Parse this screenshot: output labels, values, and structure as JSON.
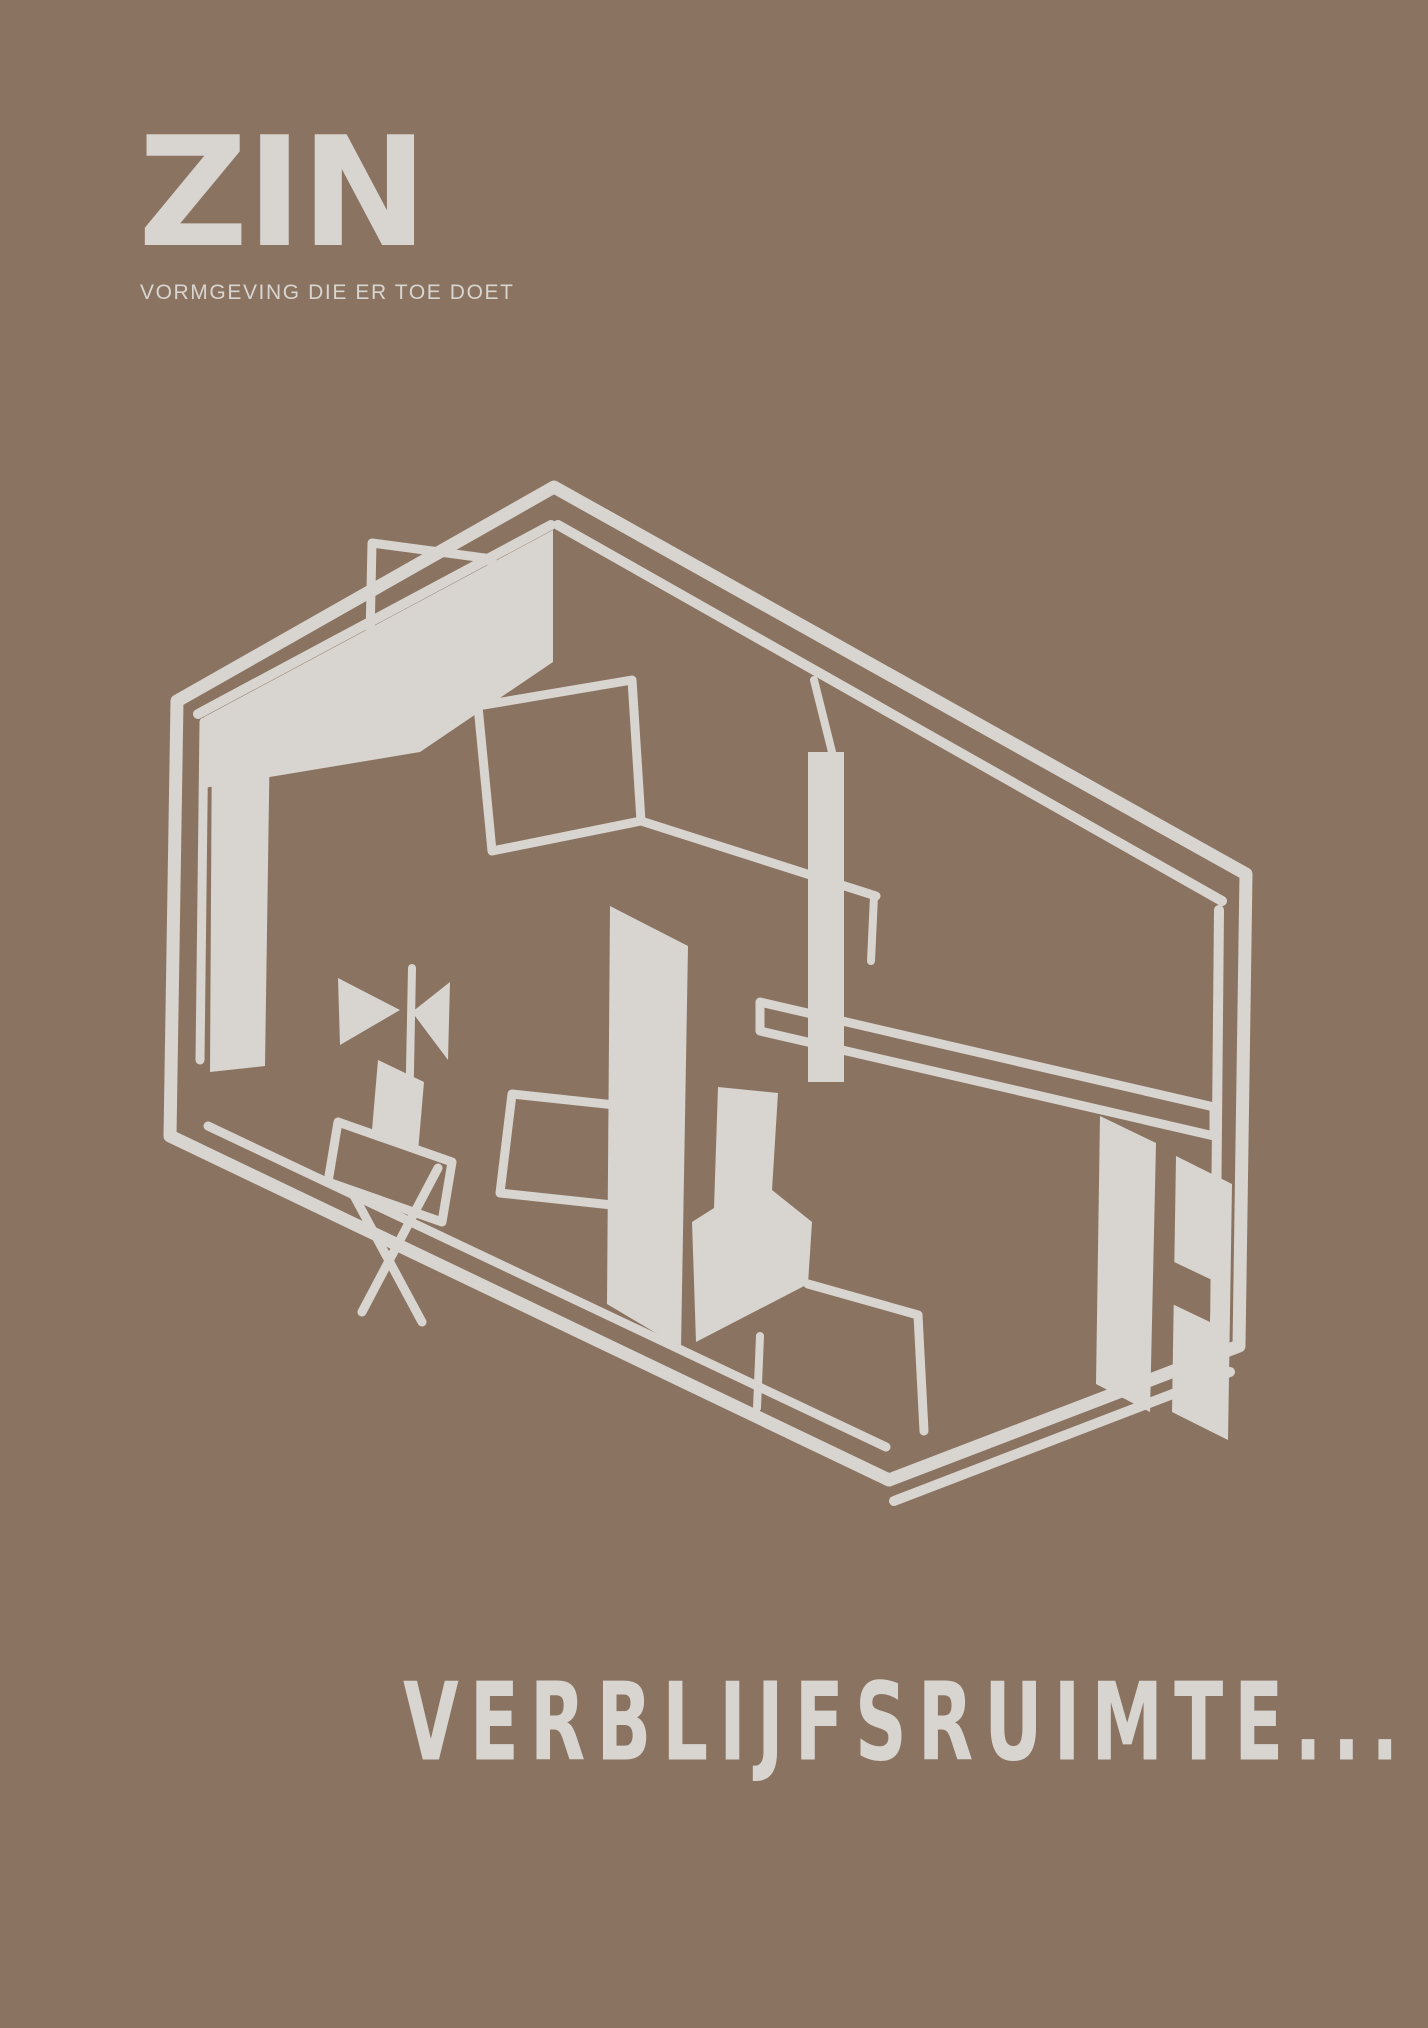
{
  "colors": {
    "background": "#8a7461",
    "ink": "#d8d4d0"
  },
  "logo": {
    "brand": "ZIN",
    "tagline": "VORMGEVING DIE ER TOE DOET"
  },
  "footer": {
    "title": "VERBLIJFSRUIMTE..."
  },
  "illustration": {
    "name": "isometric-room-sketch",
    "description": "Hand-drawn isometric cutaway sketch, in light grey on brown, of a rectangular room (verblijfsruimte) showing interior walls, a desk with screen panel, chairs, a small table, a partition, a hanging lamp and a long wall shelf."
  }
}
